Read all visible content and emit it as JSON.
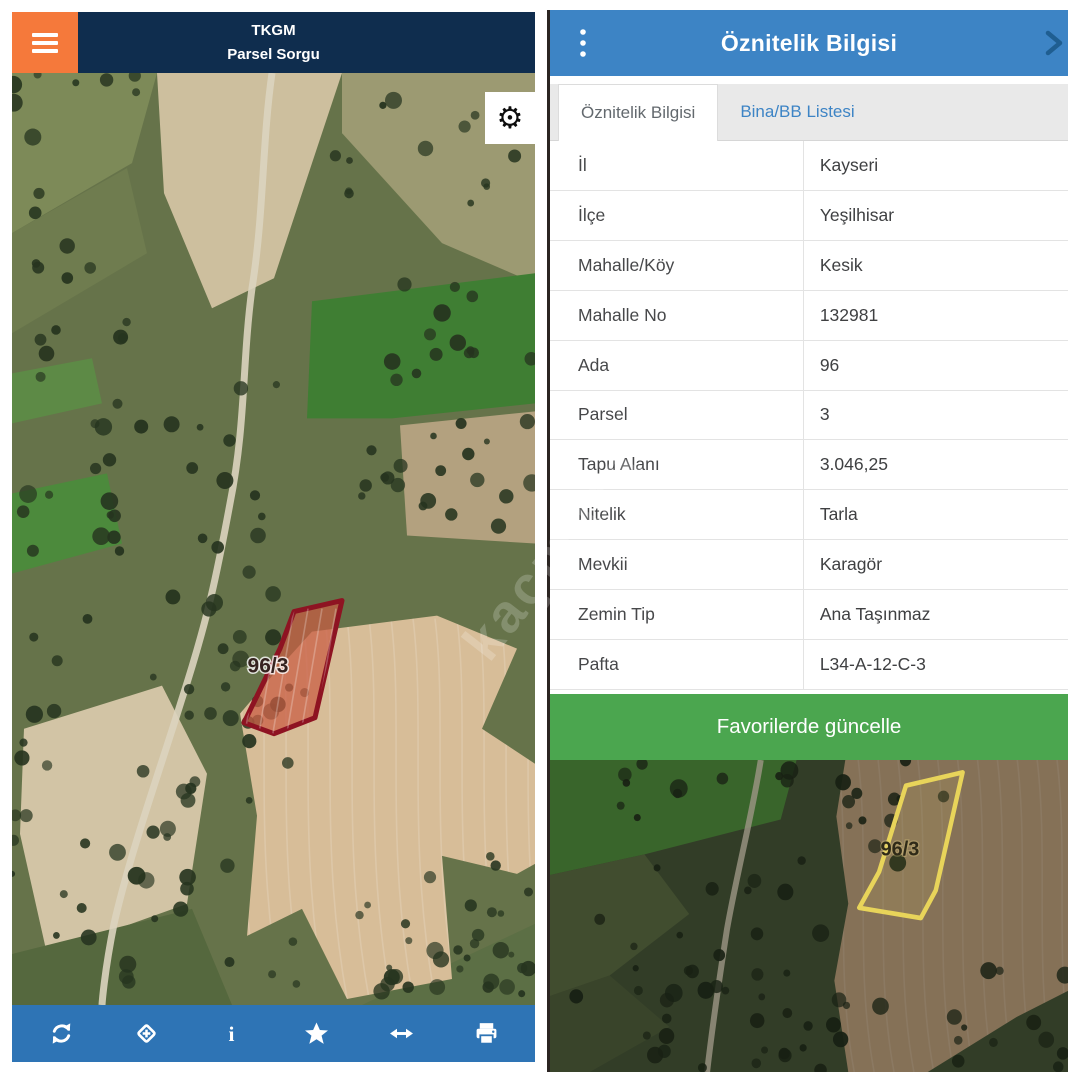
{
  "left_panel": {
    "header": {
      "app_title": "TKGM",
      "subtitle": "Parsel Sorgu"
    },
    "map": {
      "parcel_label": "96/3"
    },
    "gear_glyph": "⚙",
    "toolbar": {
      "icons": [
        "refresh",
        "locate",
        "info",
        "favorite",
        "measure",
        "print"
      ]
    }
  },
  "right_panel": {
    "header": {
      "title": "Öznitelik Bilgisi"
    },
    "tabs": [
      {
        "label": "Öznitelik Bilgisi",
        "active": true
      },
      {
        "label": "Bina/BB Listesi",
        "active": false
      }
    ],
    "table": {
      "rows": [
        {
          "label": "İl",
          "value": "Kayseri"
        },
        {
          "label": "İlçe",
          "value": "Yeşilhisar"
        },
        {
          "label": "Mahalle/Köy",
          "value": "Kesik"
        },
        {
          "label": "Mahalle No",
          "value": "132981"
        },
        {
          "label": "Ada",
          "value": "96"
        },
        {
          "label": "Parsel",
          "value": "3"
        },
        {
          "label": "Tapu Alanı",
          "value": "3.046,25"
        },
        {
          "label": "Nitelik",
          "value": "Tarla"
        },
        {
          "label": "Mevkii",
          "value": "Karagör"
        },
        {
          "label": "Zemin Tip",
          "value": "Ana Taşınmaz"
        },
        {
          "label": "Pafta",
          "value": "L34-A-12-C-3"
        }
      ]
    },
    "favorite_button": {
      "label": "Favorilerde güncelle"
    },
    "map": {
      "parcel_label": "96/3"
    }
  },
  "watermark": "kaçmaza",
  "colors": {
    "navy": "#0f2d4e",
    "orange": "#f5793b",
    "toolbar_blue": "#2e74b5",
    "header_blue": "#3d84c5",
    "green": "#4ba64f",
    "parcel_red": "#8e1322",
    "parcel_yellow": "#e8d45a"
  }
}
